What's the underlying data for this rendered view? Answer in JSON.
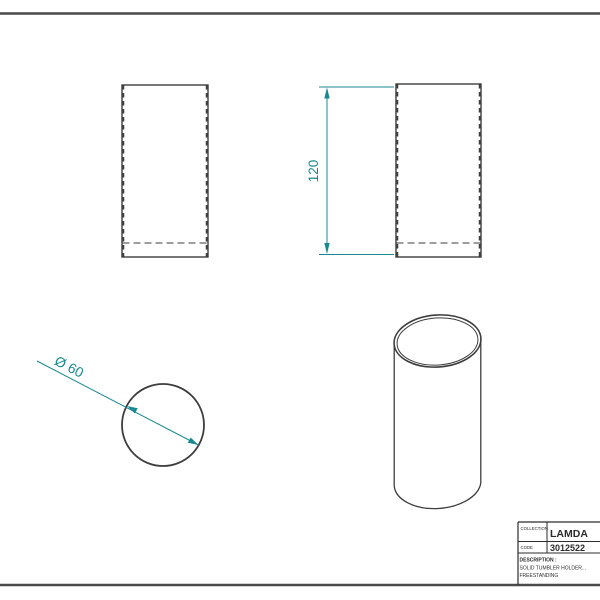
{
  "sheet": {
    "type": "technical-drawing",
    "colors": {
      "line": "#3d3d3d",
      "border": "#4a4a4a",
      "dimension": "#19898f",
      "background": "#ffffff"
    }
  },
  "dimensions": {
    "height": "120",
    "diameter": "Ø 60"
  },
  "title_block": {
    "collection_label": "COLLECTION",
    "collection_value": "LAMDA",
    "code_label": "CODE",
    "code_value": "3012522",
    "description_label": "DESCRIPTION :",
    "description_line1": "SOLID TUMBLER HOLDER...",
    "description_line2": "FREESTANDING"
  }
}
